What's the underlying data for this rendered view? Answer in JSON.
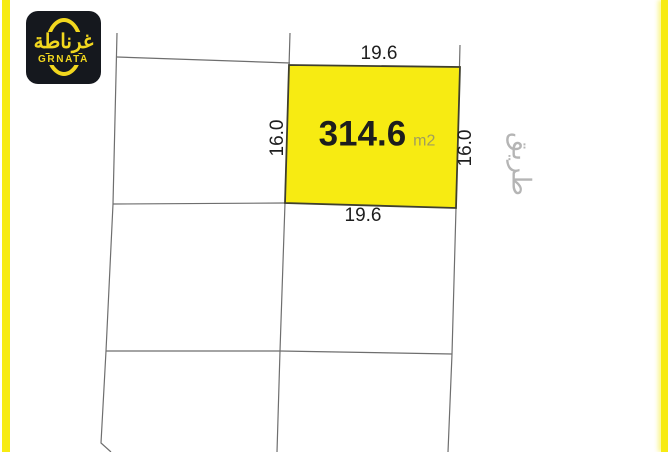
{
  "branding": {
    "logo_arabic": "غرناطة",
    "logo_latin": "GRNATA"
  },
  "parcel": {
    "area_value": "314.6",
    "area_unit": "m2",
    "top_dim": "19.6",
    "bottom_dim": "19.6",
    "left_dim": "16.0",
    "right_dim": "16.0"
  },
  "road_label": "طريق",
  "colors": {
    "accent_yellow": "#f7eb12",
    "logo_background": "#15181e",
    "logo_yellow": "#f2d71e",
    "boundary_gray": "#6e6e6e",
    "parcel_border": "#3f3f2e",
    "dimension_text": "#1e1e1e",
    "unit_text": "#a09d5e",
    "road_text": "#b5b5b5"
  }
}
